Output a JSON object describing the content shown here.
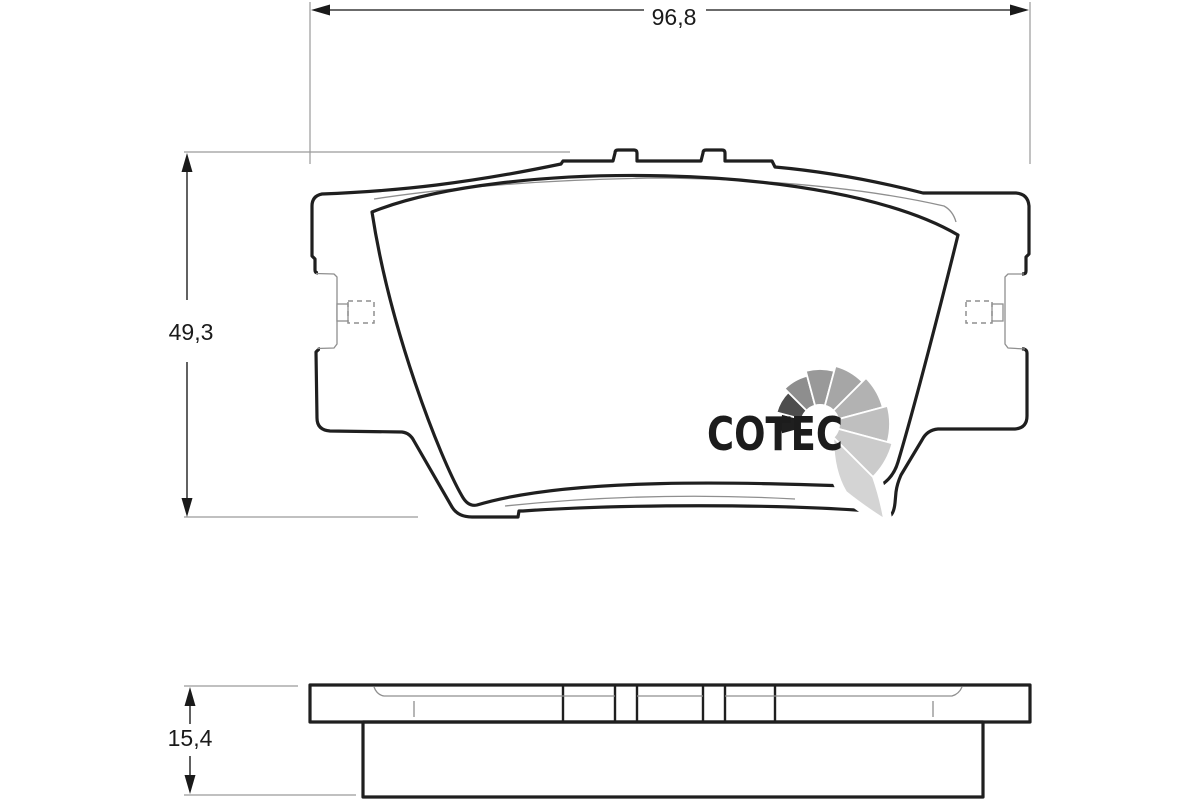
{
  "drawing": {
    "background": "#ffffff",
    "outline_color": "#1f1f1f",
    "thin_line_color": "#8f8f8f",
    "dim_line_color": "#3a3a3a",
    "text_color": "#1a1a1a",
    "pad_friction_fill_top": "#f7b49e",
    "pad_friction_fill_side": "#f5ae97"
  },
  "dimensions": {
    "width_label": "96,8",
    "height_label": "49,3",
    "thickness_label": "15,4"
  },
  "logo": {
    "text": "COTEC",
    "text_color": "#1c1c1c",
    "halo_color": "#ffffff",
    "fan_colors": [
      "#1f1f1f",
      "#4d4d4d",
      "#8e8e8e",
      "#999999",
      "#a6a6a6",
      "#b2b2b2",
      "#bfbfbf",
      "#cbcbcb"
    ],
    "tail_color": "#d4d4d4"
  }
}
